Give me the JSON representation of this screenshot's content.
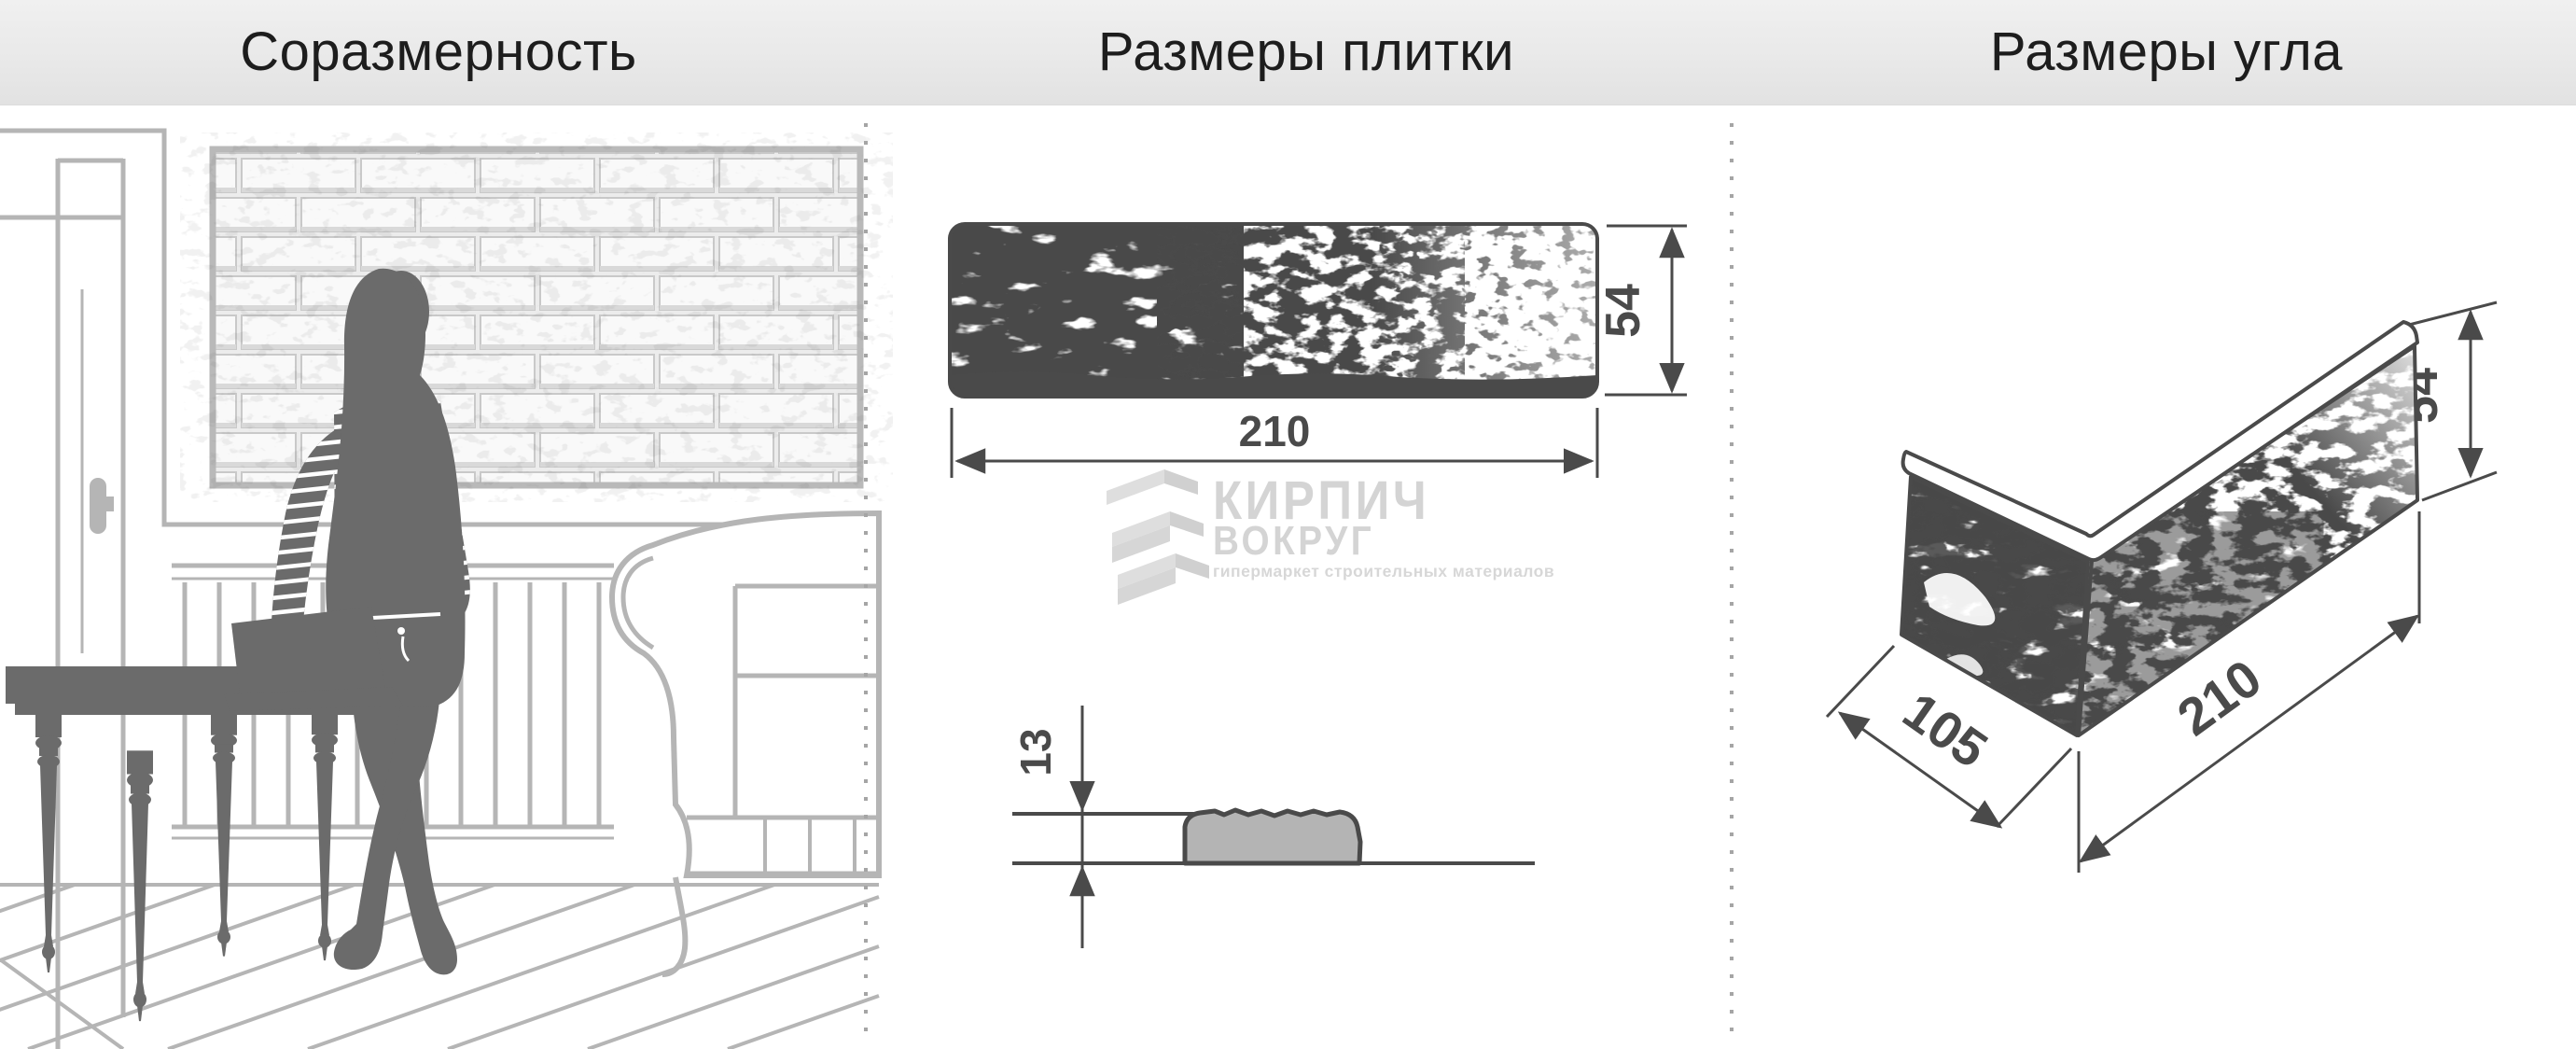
{
  "header": {
    "panel1": "Соразмерность",
    "panel2": "Размеры плитки",
    "panel3": "Размеры угла"
  },
  "tile": {
    "width": "210",
    "height": "54",
    "thickness": "13"
  },
  "corner": {
    "depth": "105",
    "length": "210",
    "height": "54"
  },
  "logo": {
    "word1": "КИРПИЧ",
    "word2": "ВОКРУГ",
    "tagline": "гипермаркет строительных материалов",
    "icon": "brick-zigzag-icon"
  },
  "colors": {
    "dimension": "#4a4a4a",
    "scene_line": "#b5b5b5",
    "silhouette": "#6b6b6b",
    "logo_text": "#d4d4d4",
    "header_bg": "#e9e9e9",
    "divider_dot": "#a5a5a5",
    "profile_fill": "#b4b4b4"
  }
}
